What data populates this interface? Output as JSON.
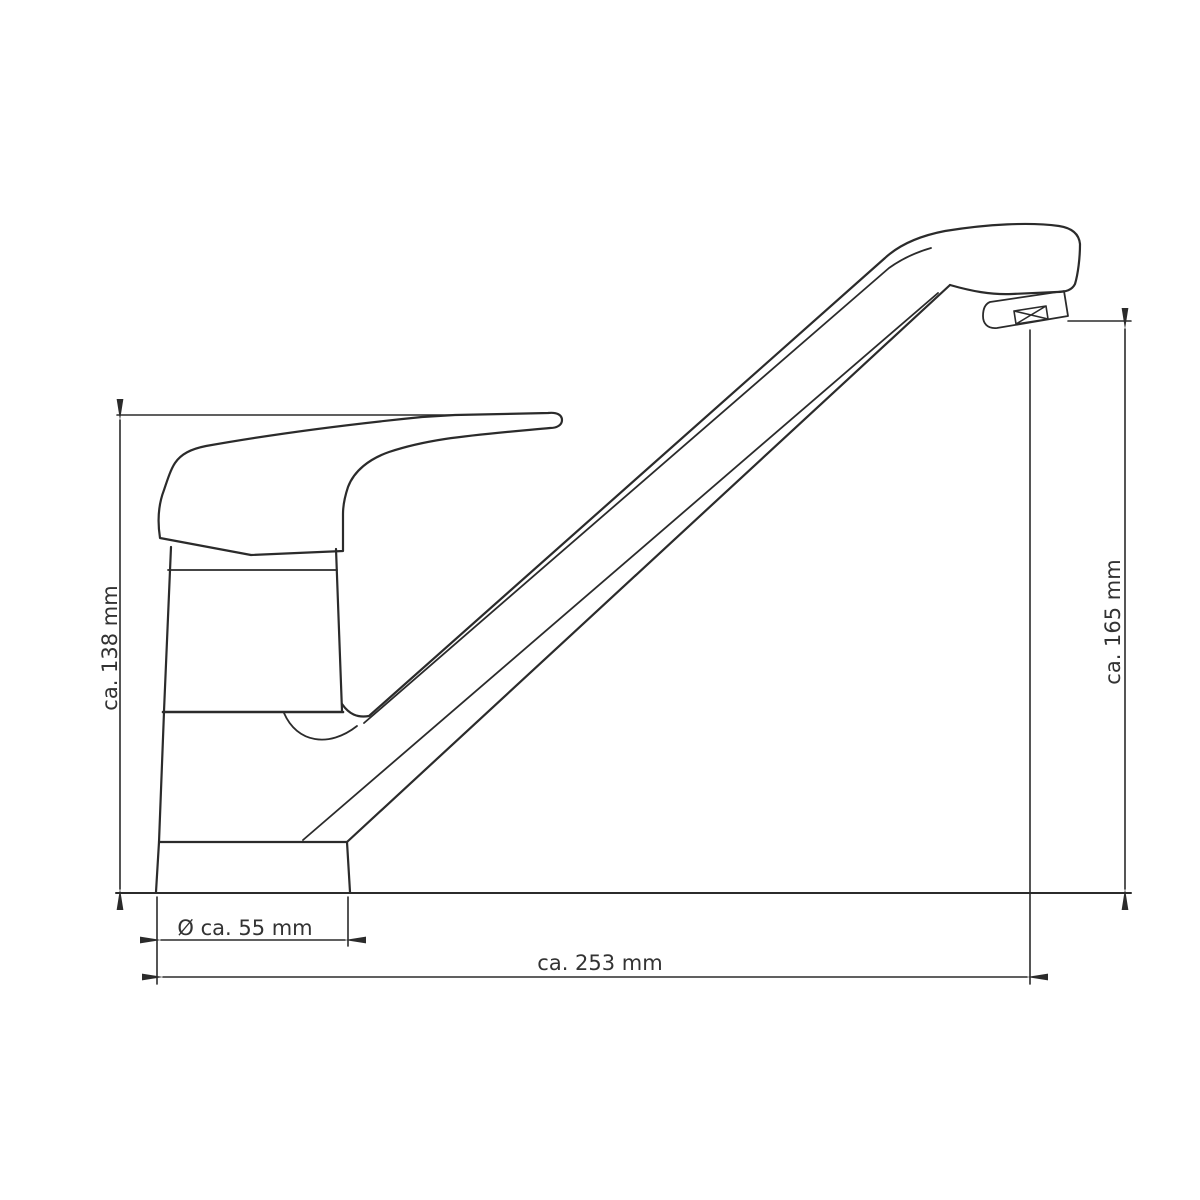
{
  "labels": {
    "height_left": "ca. 138 mm",
    "height_right": "ca. 165 mm",
    "base_diameter": "Ø ca. 55 mm",
    "length_total": "ca. 253 mm"
  },
  "colors": {
    "background": "#ffffff",
    "line": "#2b2b2b",
    "text": "#333333"
  }
}
